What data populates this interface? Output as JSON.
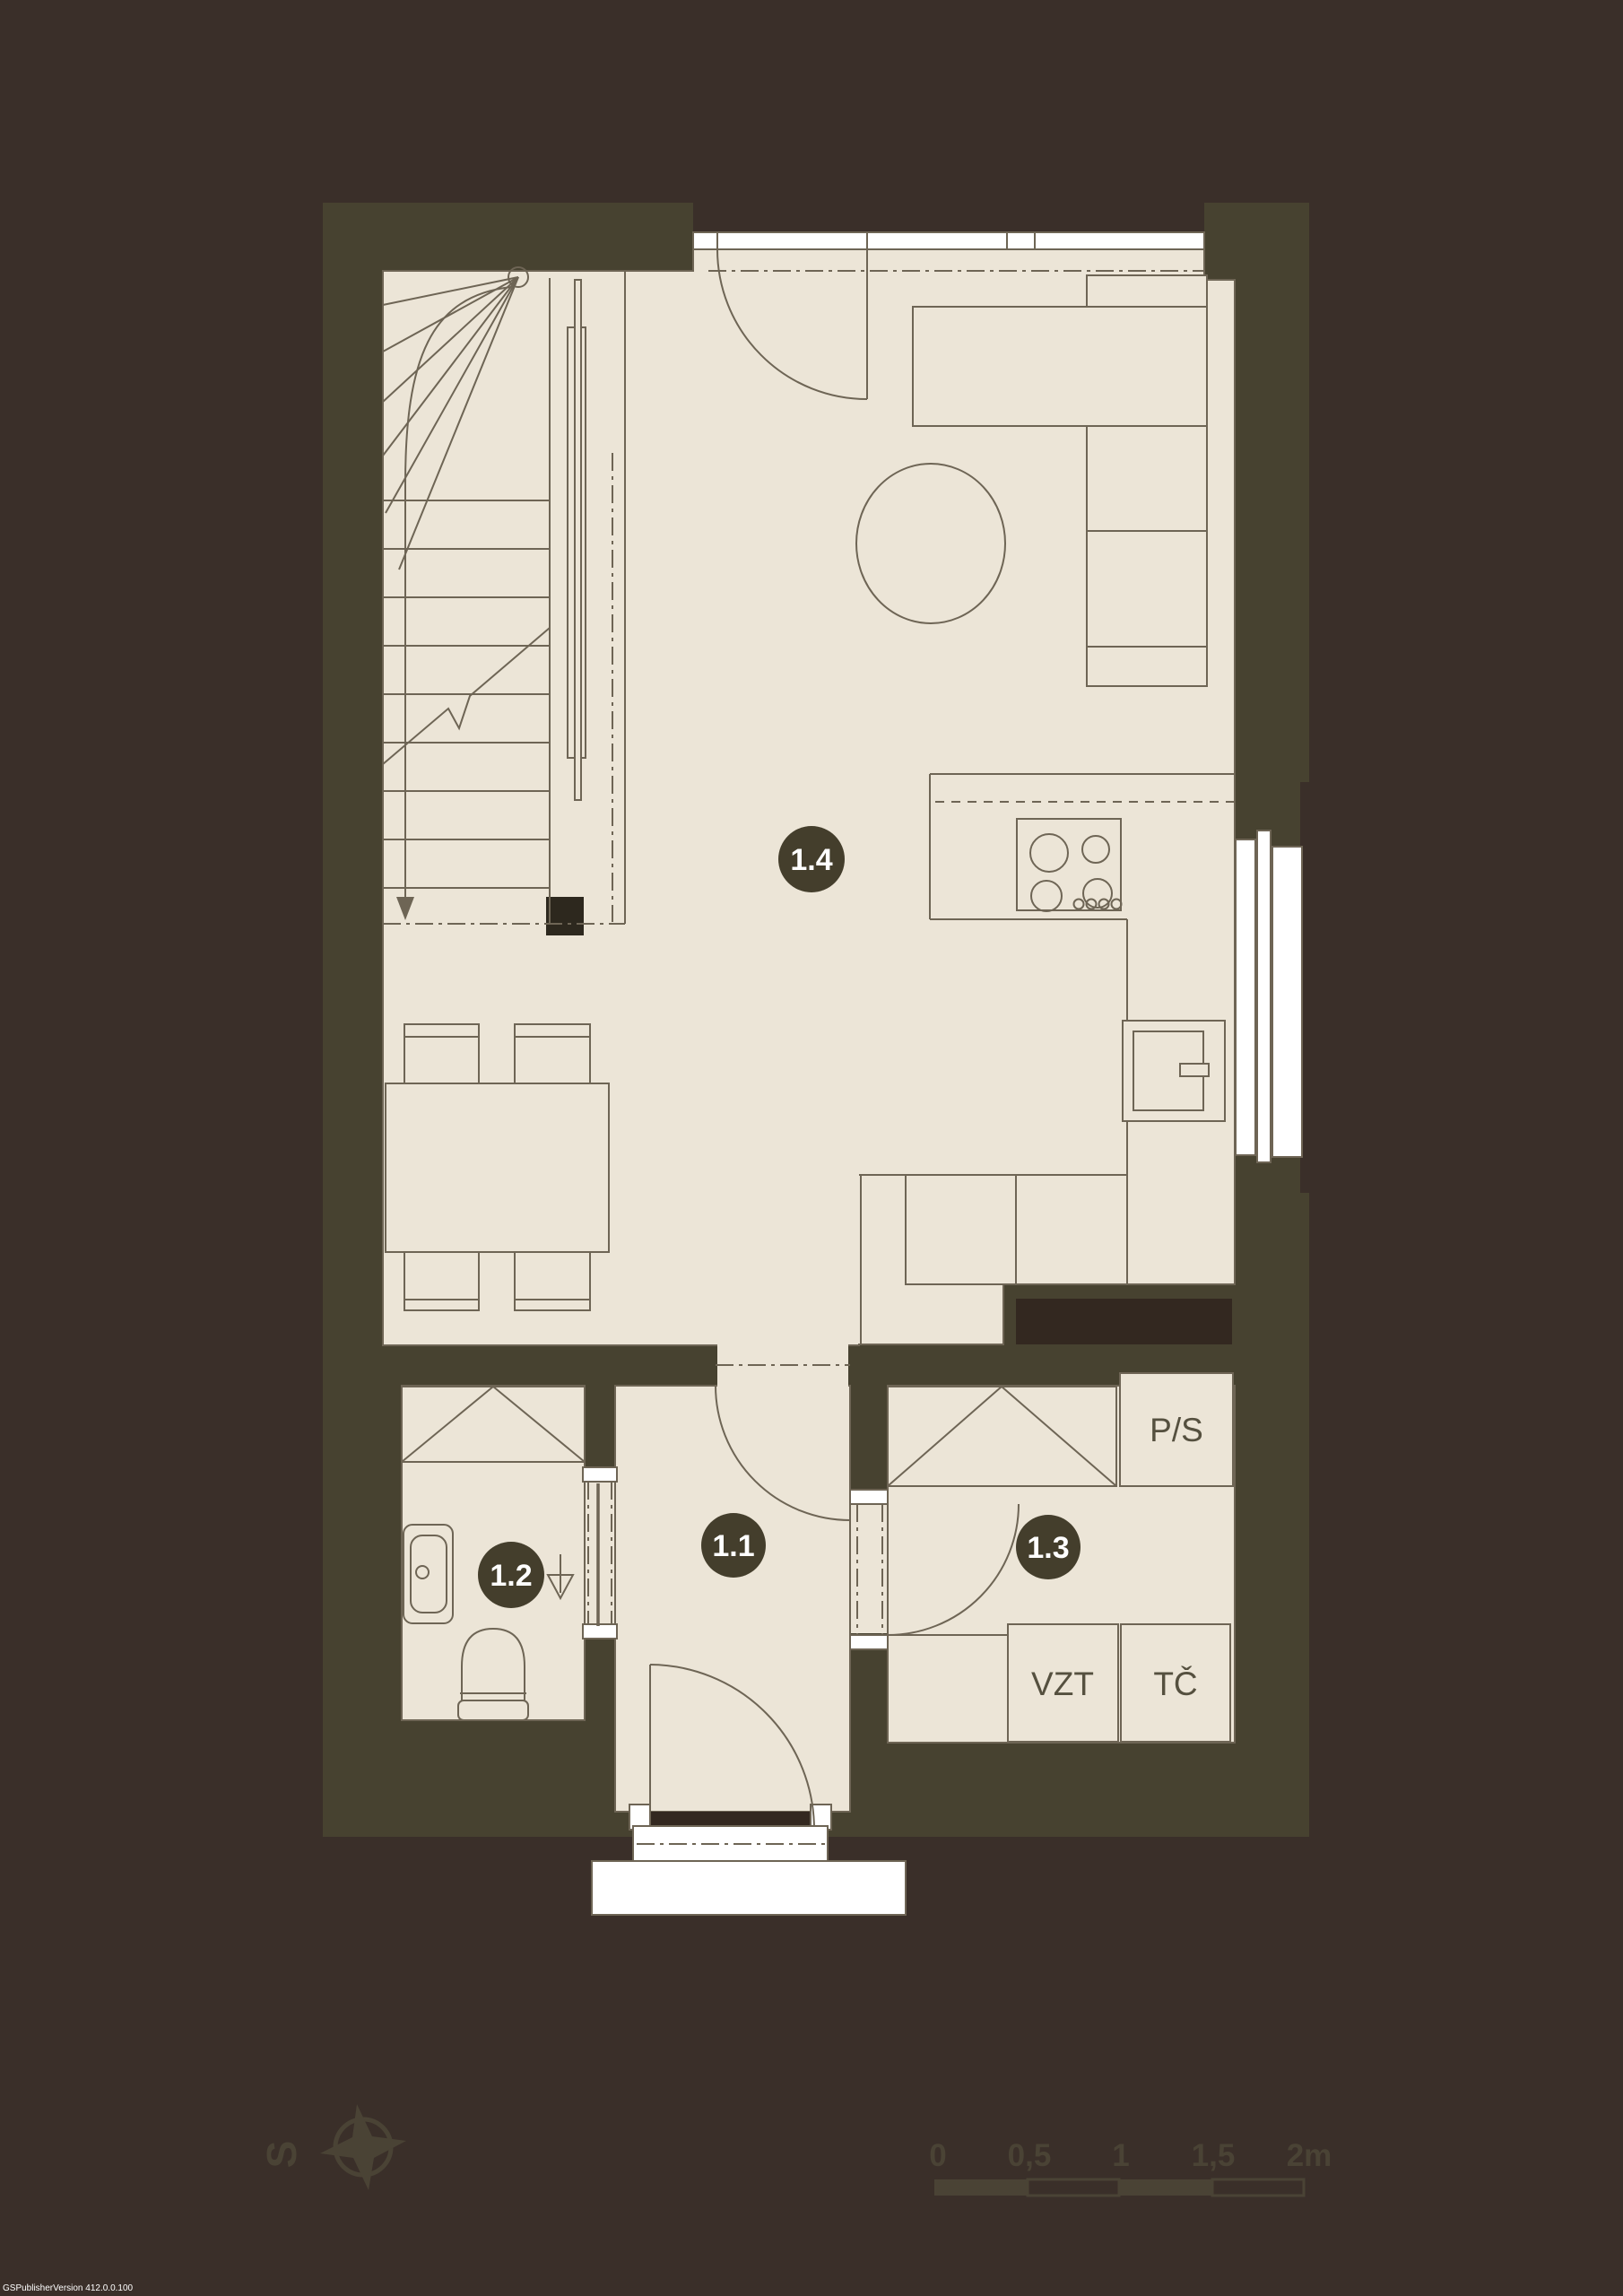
{
  "plan": {
    "rooms": {
      "hall": {
        "number": "1.1"
      },
      "bathroom": {
        "number": "1.2"
      },
      "tech_room": {
        "number": "1.3"
      },
      "living_kitchen": {
        "number": "1.4"
      }
    },
    "equipment_labels": {
      "washer_dryer": "P/S",
      "ventilation_unit": "VZT",
      "heat_pump": "TČ"
    }
  },
  "compass": {
    "north_letter": "S"
  },
  "scale_bar": {
    "labels": [
      "0",
      "0,5",
      "1",
      "1,5",
      "2m"
    ]
  },
  "watermark": "GSPublisherVersion 412.0.0.100",
  "colors": {
    "bg": "#3a2f29",
    "bg-dark": "#332820",
    "wall": "#474230",
    "wall-light": "#4a4335",
    "floor": "#ece5d7",
    "line": "#6e6555",
    "badge": "#443e2c",
    "text": "#55503f",
    "ink": "#2d281e",
    "white": "#ffffff"
  }
}
